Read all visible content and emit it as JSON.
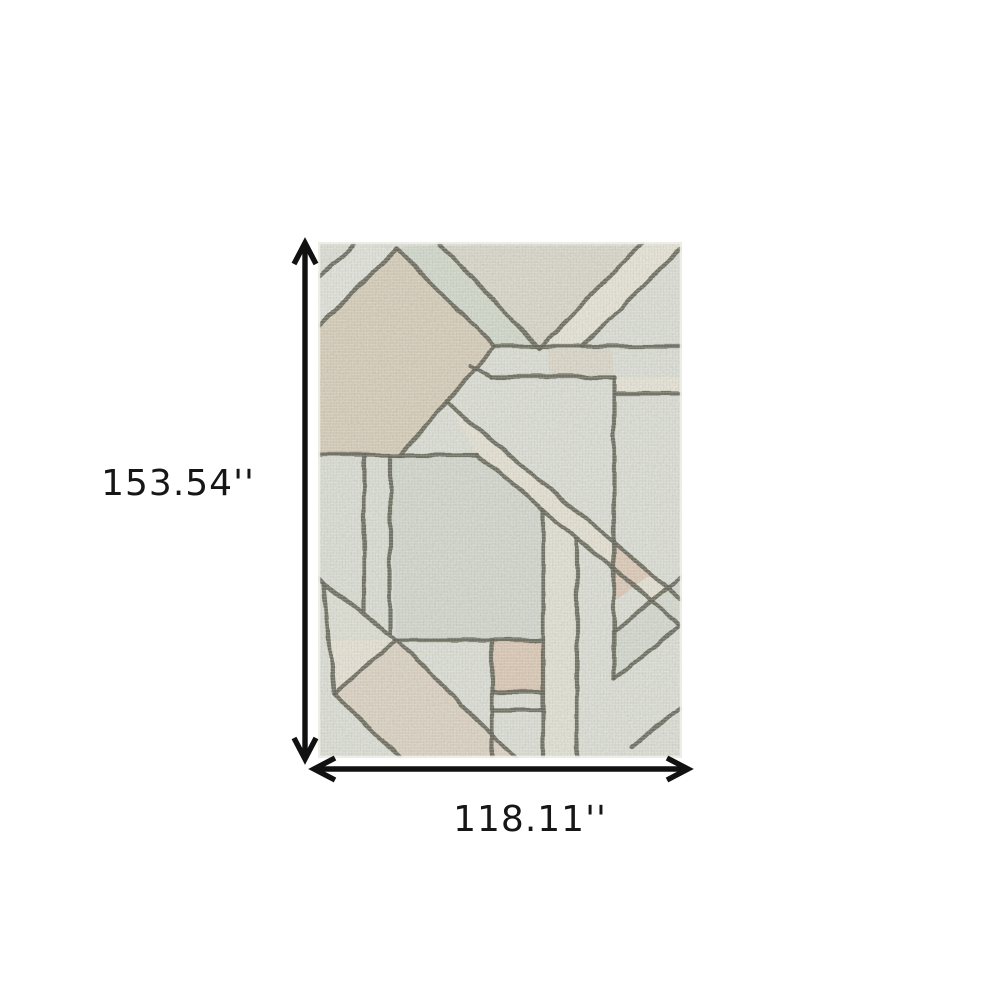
{
  "dimensions": {
    "height_label": "153.54''",
    "width_label": "118.11''"
  },
  "style": {
    "canvas_bg": "#ffffff",
    "text_color": "#161616",
    "arrow_color": "#111111",
    "rug_base": "#e3e5dc",
    "rug_edge": "#eef0e8",
    "line_color": "#6d6d5f",
    "line_width": 4.2,
    "arrow_stroke_width": 5.4
  },
  "rug": {
    "fills": [
      {
        "pts": "0,86 79,6 177,104 82,213 0,213",
        "fill": "#ddd3c0",
        "op": 0.95
      },
      {
        "pts": "0,86 3,34 36,2 79,6",
        "fill": "#e8e9e1",
        "op": 0.9
      },
      {
        "pts": "79,6 122,2 221,106 177,104",
        "fill": "#d8ded1",
        "op": 0.9
      },
      {
        "pts": "124,4 322,4 221,104",
        "fill": "#dbd5c5",
        "op": 0.45
      },
      {
        "pts": "221,106 325,2 361,2 361,10 264,104",
        "fill": "#edeadd",
        "op": 1
      },
      {
        "pts": "296,135 362,135 362,152 298,152",
        "fill": "#edeadd",
        "op": 1
      },
      {
        "pts": "128,160 362,356 362,382 160,213",
        "fill": "#ebe8da",
        "op": 1
      },
      {
        "pts": "230,107 294,107 294,134 230,134",
        "fill": "#e4d1bf",
        "op": 0.4
      },
      {
        "pts": "72,213 160,213 225,267 225,398 78,398",
        "fill": "#d8ddd2",
        "op": 0.85
      },
      {
        "pts": "225,267 259,296 259,516 225,516",
        "fill": "#eae7db",
        "op": 0.75
      },
      {
        "pts": "174,398 225,398 225,450 174,450",
        "fill": "#e2ccb8",
        "op": 0.85
      },
      {
        "pts": "6,340 78,398 16,452",
        "fill": "#ece8db",
        "op": 1
      },
      {
        "pts": "78,398 198,516 82,516 16,452",
        "fill": "#e2cfbc",
        "op": 0.55
      },
      {
        "pts": "296,302 296,360 334,331",
        "fill": "#e1cab5",
        "op": 0.75
      },
      {
        "pts": "296,390 362,336 362,384 296,437",
        "fill": "#d9ded3",
        "op": 0.85
      },
      {
        "pts": "0,213 72,213 72,398 0,398",
        "fill": "#dfe2d8",
        "op": 0.6
      }
    ],
    "lines": [
      "36,2 3,34",
      "79,6 2,84",
      "79,6 177,104",
      "177,104 362,104",
      "122,2 221,106",
      "221,106 325,2",
      "264,104 361,8",
      "177,104 82,213",
      "152,124 172,135",
      "172,135 296,135",
      "296,135 296,437",
      "298,152 362,152",
      "0,213 160,213",
      "128,160 362,356",
      "160,213 362,382",
      "46,213 46,370",
      "72,213 72,390",
      "76,398 225,398",
      "0,336 78,398",
      "6,341 16,452",
      "16,452 78,398",
      "78,398 198,516",
      "16,452 82,516",
      "174,398 174,516",
      "225,267 225,516",
      "174,450 225,450",
      "174,468 225,468",
      "259,298 259,516",
      "296,390 362,336",
      "296,437 362,384",
      "314,505 362,466"
    ]
  },
  "arrows": {
    "vertical": [
      "305,247 305,755",
      "294,264 305,243 316,264",
      "294,738 305,759 316,738"
    ],
    "horizontal": [
      "318,769 684,769",
      "335,758 314,769 335,780",
      "667,758 688,769 667,780"
    ]
  }
}
